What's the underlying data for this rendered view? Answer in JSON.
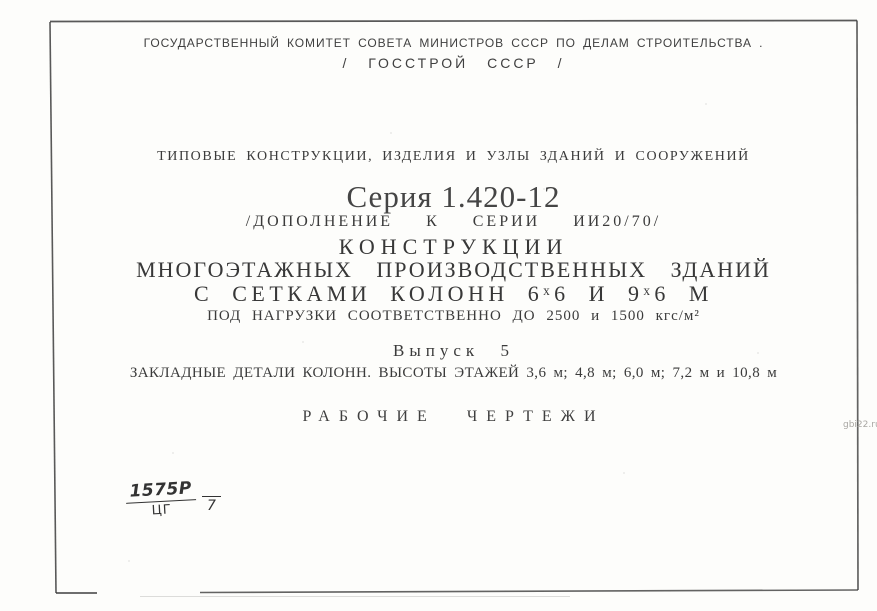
{
  "colors": {
    "ink": "#3b3b3b",
    "paper": "#fdfdfb",
    "frame": "#3c3c3c",
    "watermark": "#a9a7a3"
  },
  "watermark": "gbi22.ru",
  "header": {
    "committee": "ГОСУДАРСТВЕННЫЙ КОМИТЕТ СОВЕТА МИНИСТРОВ СССР ПО ДЕЛАМ СТРОИТЕЛЬСТВА .",
    "gosstroy": "/ ГОССТРОЙ СССР /"
  },
  "title_block": {
    "series_type": "ТИПОВЫЕ КОНСТРУКЦИИ, ИЗДЕЛИЯ И УЗЛЫ ЗДАНИЙ И СООРУЖЕНИЙ",
    "series_number": "Серия 1.420-12",
    "supplement": "/ДОПОЛНЕНИЕ К СЕРИИ ИИ20/70/",
    "title_line1": "КОНСТРУКЦИИ",
    "title_line2": "МНОГОЭТАЖНЫХ ПРОИЗВОДСТВЕННЫХ ЗДАНИЙ",
    "title_line3": "С СЕТКАМИ КОЛОНН 6ˣ6 И 9ˣ6 М",
    "loads": "ПОД НАГРУЗКИ СООТВЕТСТВЕННО ДО 2500 и 1500 кгс/м²",
    "issue": "Выпуск 5",
    "issue_contents": "ЗАКЛАДНЫЕ ДЕТАЛИ КОЛОНН. ВЫСОТЫ ЭТАЖЕЙ 3,6 м; 4,8 м; 6,0 м; 7,2 м и 10,8 м",
    "doc_type": "РАБОЧИЕ ЧЕРТЕЖИ"
  },
  "stamp": {
    "numerator": "1575Р",
    "denominator": "ЦГ",
    "sheet": "7"
  }
}
